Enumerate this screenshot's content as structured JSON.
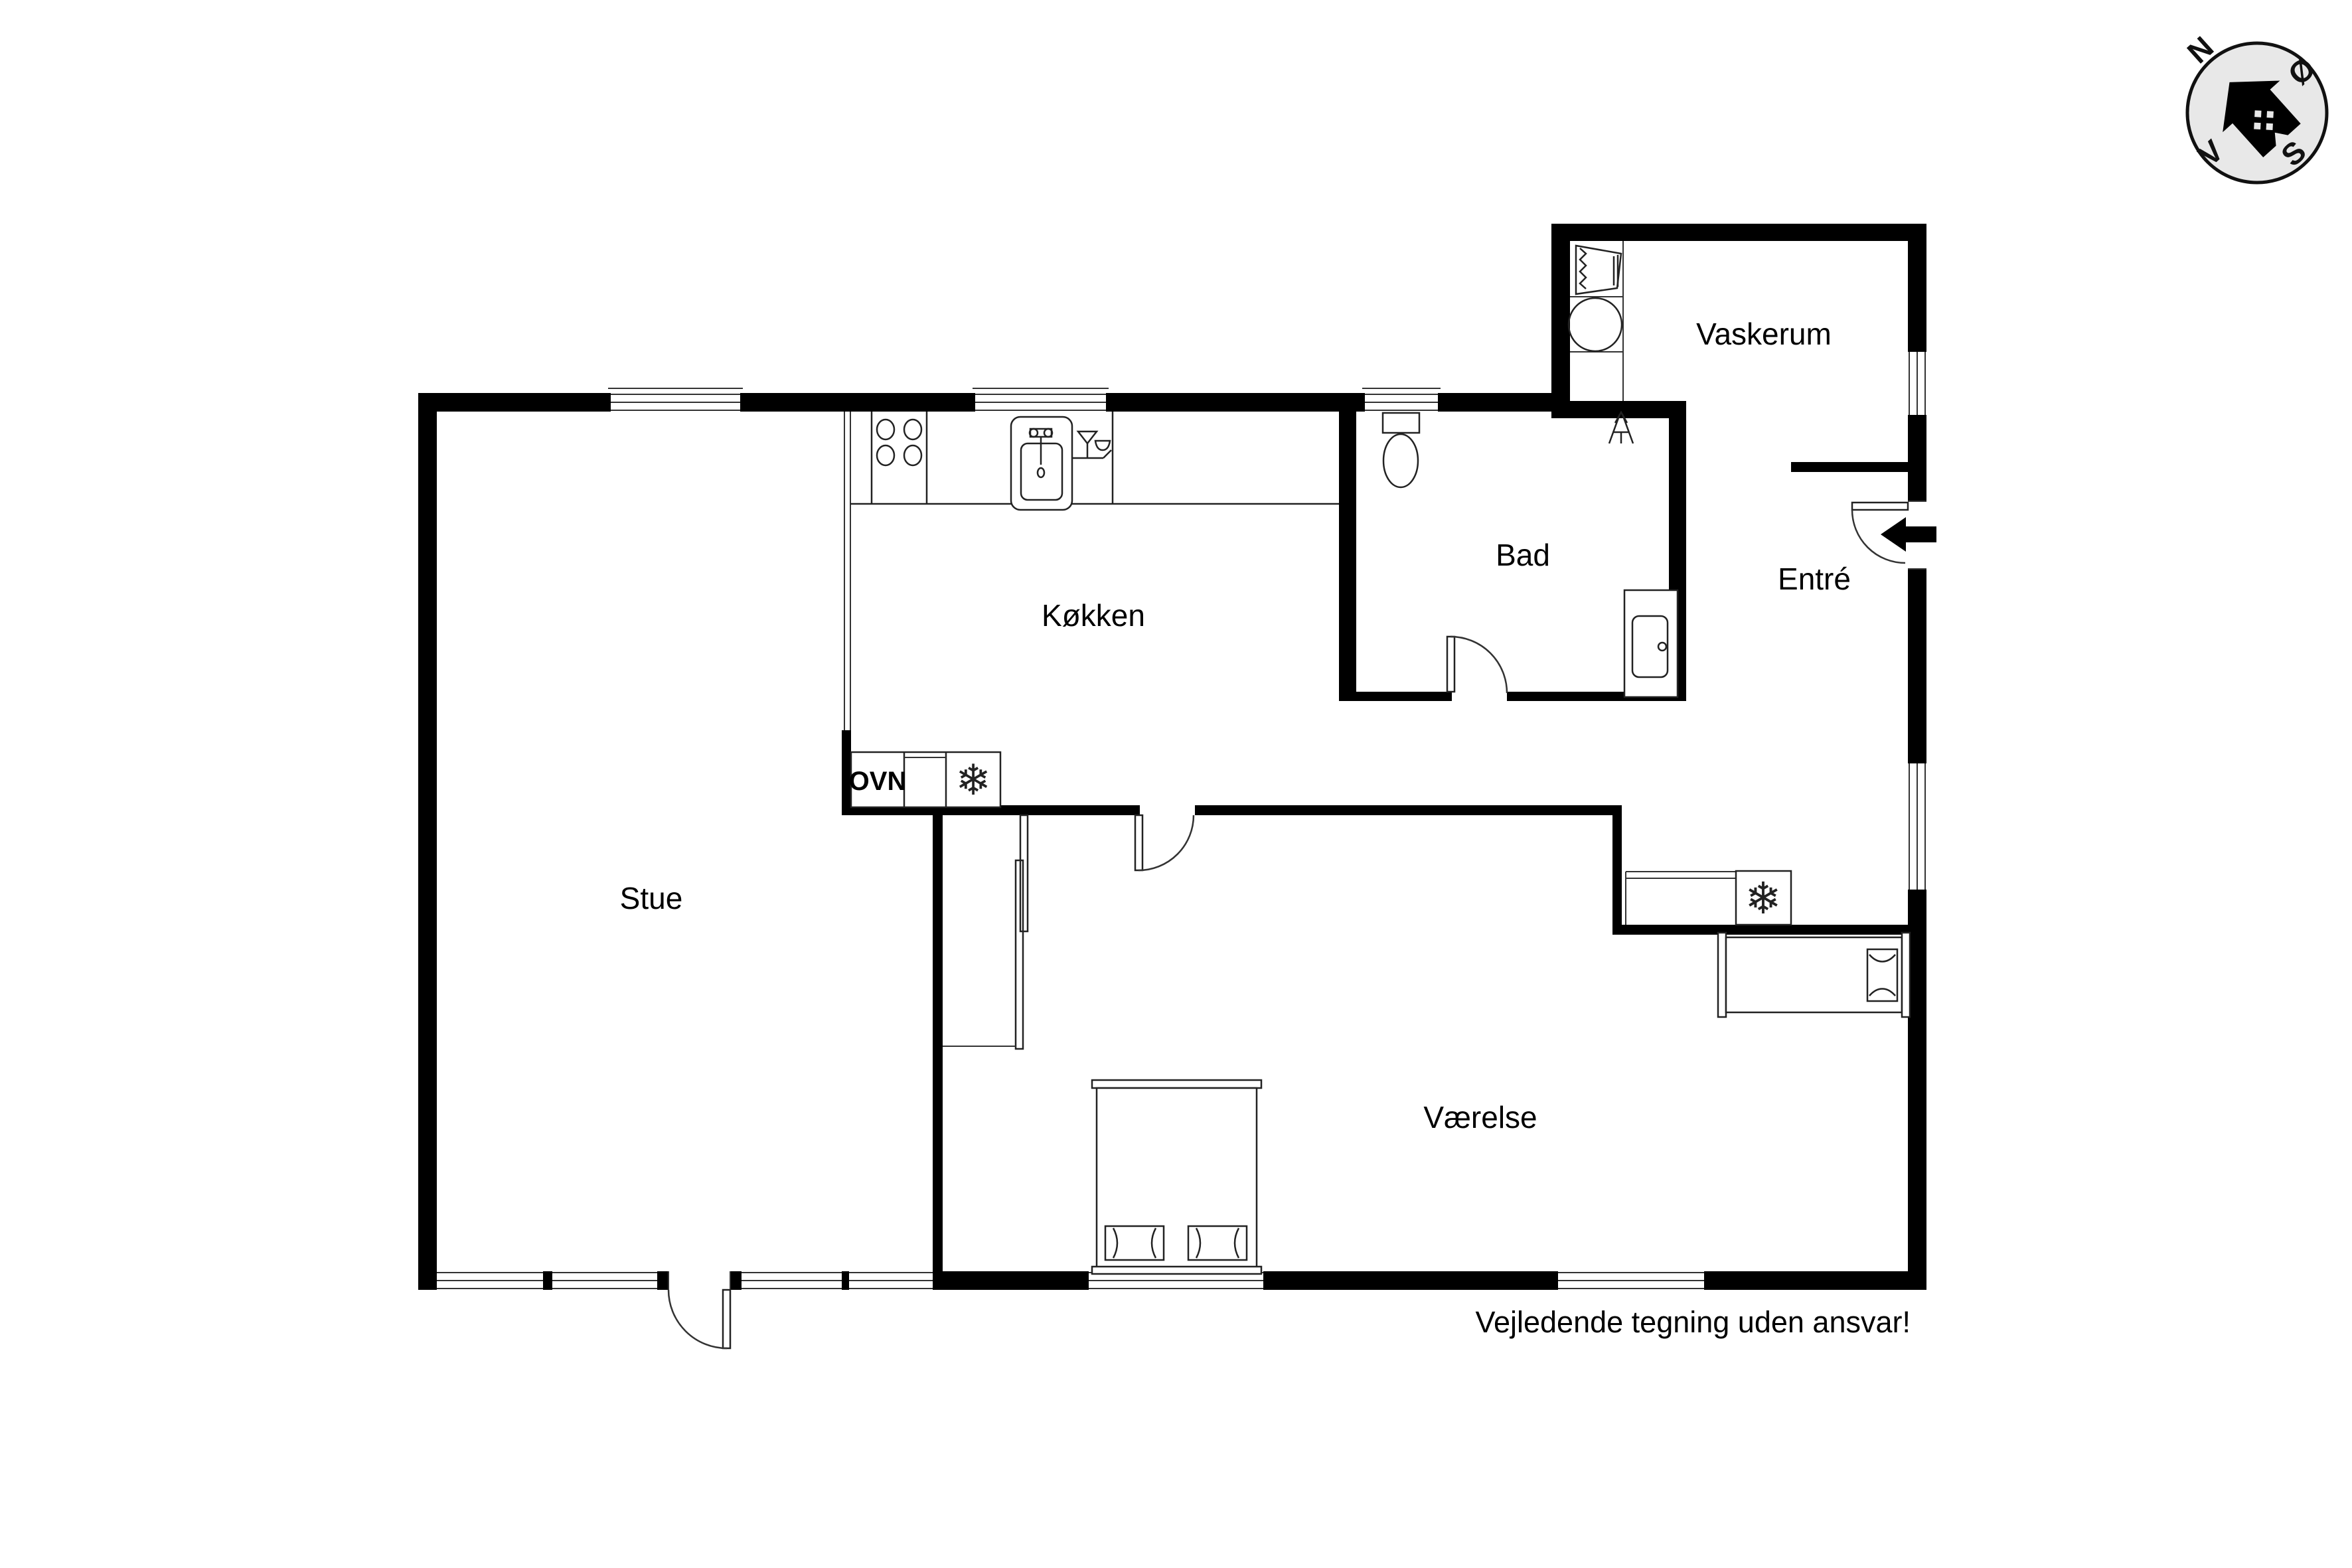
{
  "rooms": {
    "vaskerum": {
      "label": "Vaskerum"
    },
    "bad": {
      "label": "Bad"
    },
    "entre": {
      "label": "Entré"
    },
    "koekken": {
      "label": "Køkken"
    },
    "stue": {
      "label": "Stue"
    },
    "vaerelse": {
      "label": "Værelse"
    }
  },
  "labels": {
    "oven": "OVN"
  },
  "icons": {
    "snowflake": "❄"
  },
  "compass": {
    "north": "N",
    "east": "Ø",
    "south": "S",
    "west": "V"
  },
  "disclaimer": "Vejledende tegning uden ansvar!",
  "colors": {
    "wall": "#000000",
    "background": "#ffffff",
    "compass_fill": "#e8e8e8",
    "line": "#222222"
  }
}
